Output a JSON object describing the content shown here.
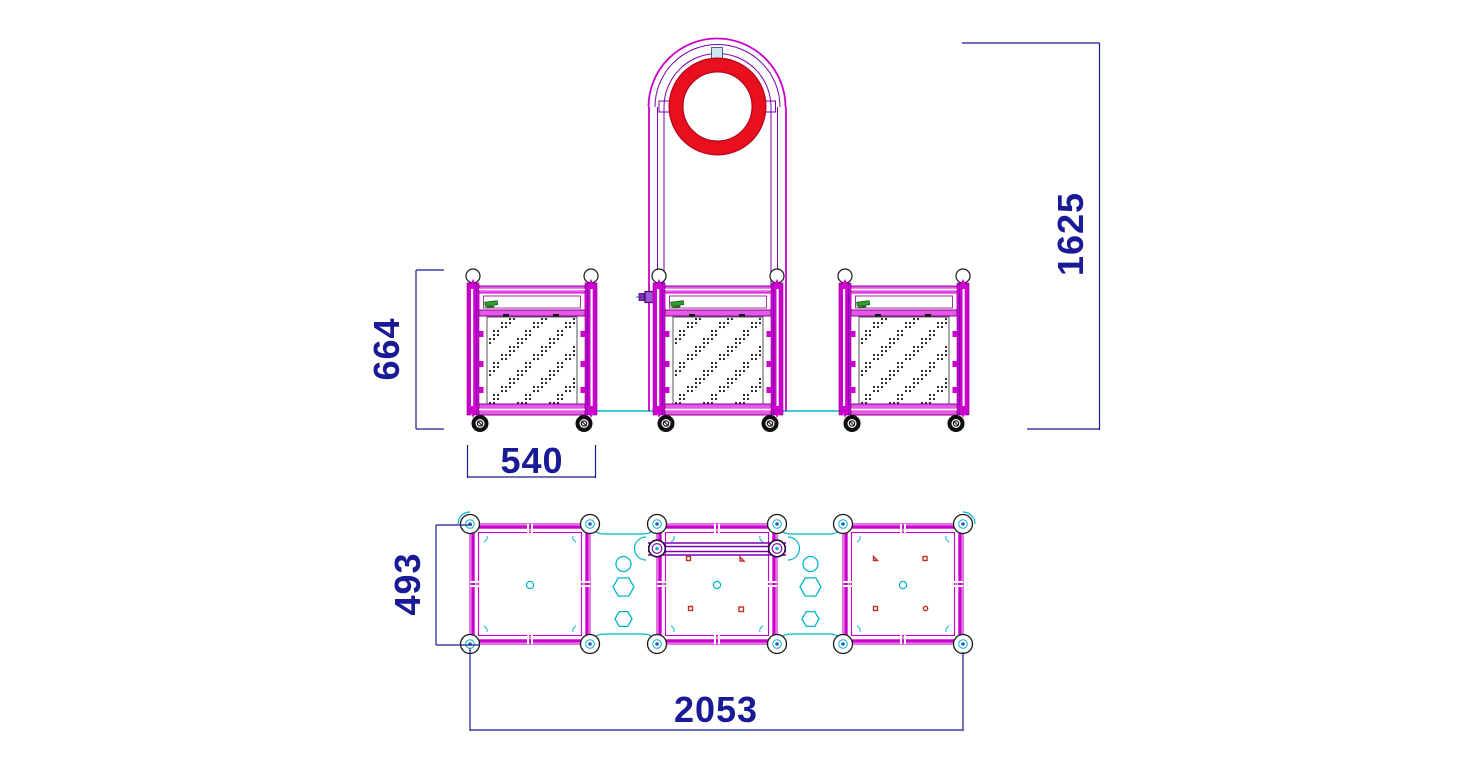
{
  "drawing": {
    "description": "CAD technical drawing: three wheeled cabinet units, centre unit with arched frame and red ring, front elevation and plan view",
    "views": {
      "front": {
        "dims": {
          "overall_height": "1625",
          "cabinet_height": "664",
          "cabinet_width": "540"
        }
      },
      "plan": {
        "dims": {
          "cabinet_depth": "493",
          "overall_length": "2053"
        }
      }
    }
  },
  "colors": {
    "paper": "#ffffff",
    "magenta": "#cc00cc",
    "magenta_light": "#e659e6",
    "magenta_dark": "#8d008d",
    "purple": "#7a00b4",
    "red": "#e8101e",
    "red_dark": "#b5001c",
    "marker_red": "#c03028",
    "navy": "#1a1a96",
    "cyan": "#00b7c8",
    "green": "#2f9e2f",
    "green_dark": "#145c14",
    "outline": "#1a1a1a"
  }
}
